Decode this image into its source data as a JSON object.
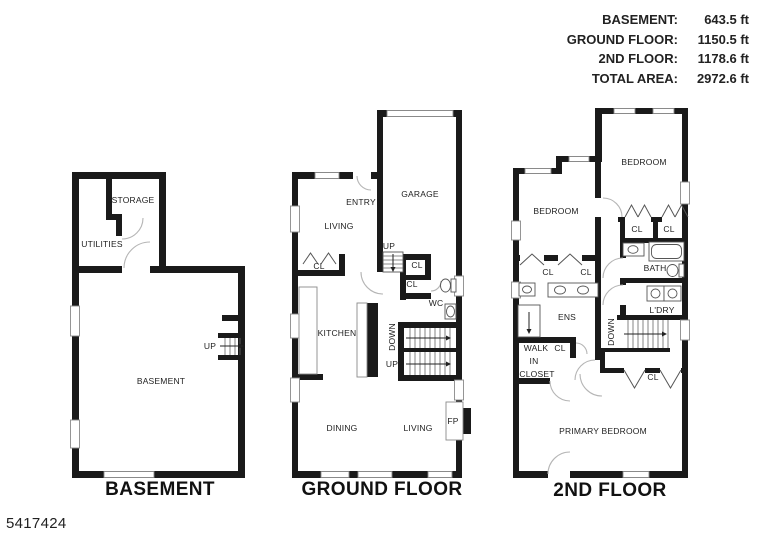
{
  "legend": {
    "rows": [
      {
        "label": "BASEMENT:",
        "value": "643.5 ft"
      },
      {
        "label": "GROUND FLOOR:",
        "value": "1150.5 ft"
      },
      {
        "label": "2ND FLOOR:",
        "value": "1178.6 ft"
      },
      {
        "label": "TOTAL AREA:",
        "value": "2972.6 ft"
      }
    ]
  },
  "plans": {
    "basement": {
      "title": "BASEMENT",
      "labels": {
        "storage": "STORAGE",
        "utilities": "UTILITIES",
        "up": "UP",
        "basement": "BASEMENT"
      }
    },
    "ground": {
      "title": "GROUND FLOOR",
      "labels": {
        "entry": "ENTRY",
        "garage": "GARAGE",
        "living_upper": "LIVING",
        "closet_left": "CL",
        "up_garage": "UP",
        "closet_1": "CL",
        "closet_2": "CL",
        "wc": "WC",
        "kitchen": "KITCHEN",
        "down": "DOWN",
        "up_stairs": "UP",
        "dining": "DINING",
        "living_lower": "LIVING",
        "fireplace": "FP"
      }
    },
    "second": {
      "title": "2ND FLOOR",
      "labels": {
        "bedroom_left": "BEDROOM",
        "bedroom_right": "BEDROOM",
        "closet_top_1": "CL",
        "closet_top_2": "CL",
        "closet_bed1_1": "CL",
        "closet_bed1_2": "CL",
        "bath": "BATH",
        "ens": "ENS",
        "laundry": "L'DRY",
        "down": "DOWN",
        "walk": "WALK",
        "in": "IN",
        "closet_word": "CLOSET",
        "closet_mid": "CL",
        "closet_bottom": "CL",
        "primary": "PRIMARY BEDROOM"
      }
    }
  },
  "footer": {
    "listing_id": "5417424"
  },
  "colors": {
    "wall": "#1a1a1a",
    "door_arc": "#b5b5b5",
    "window_outline": "#8a8a8a",
    "text": "#222222",
    "background": "#ffffff"
  }
}
